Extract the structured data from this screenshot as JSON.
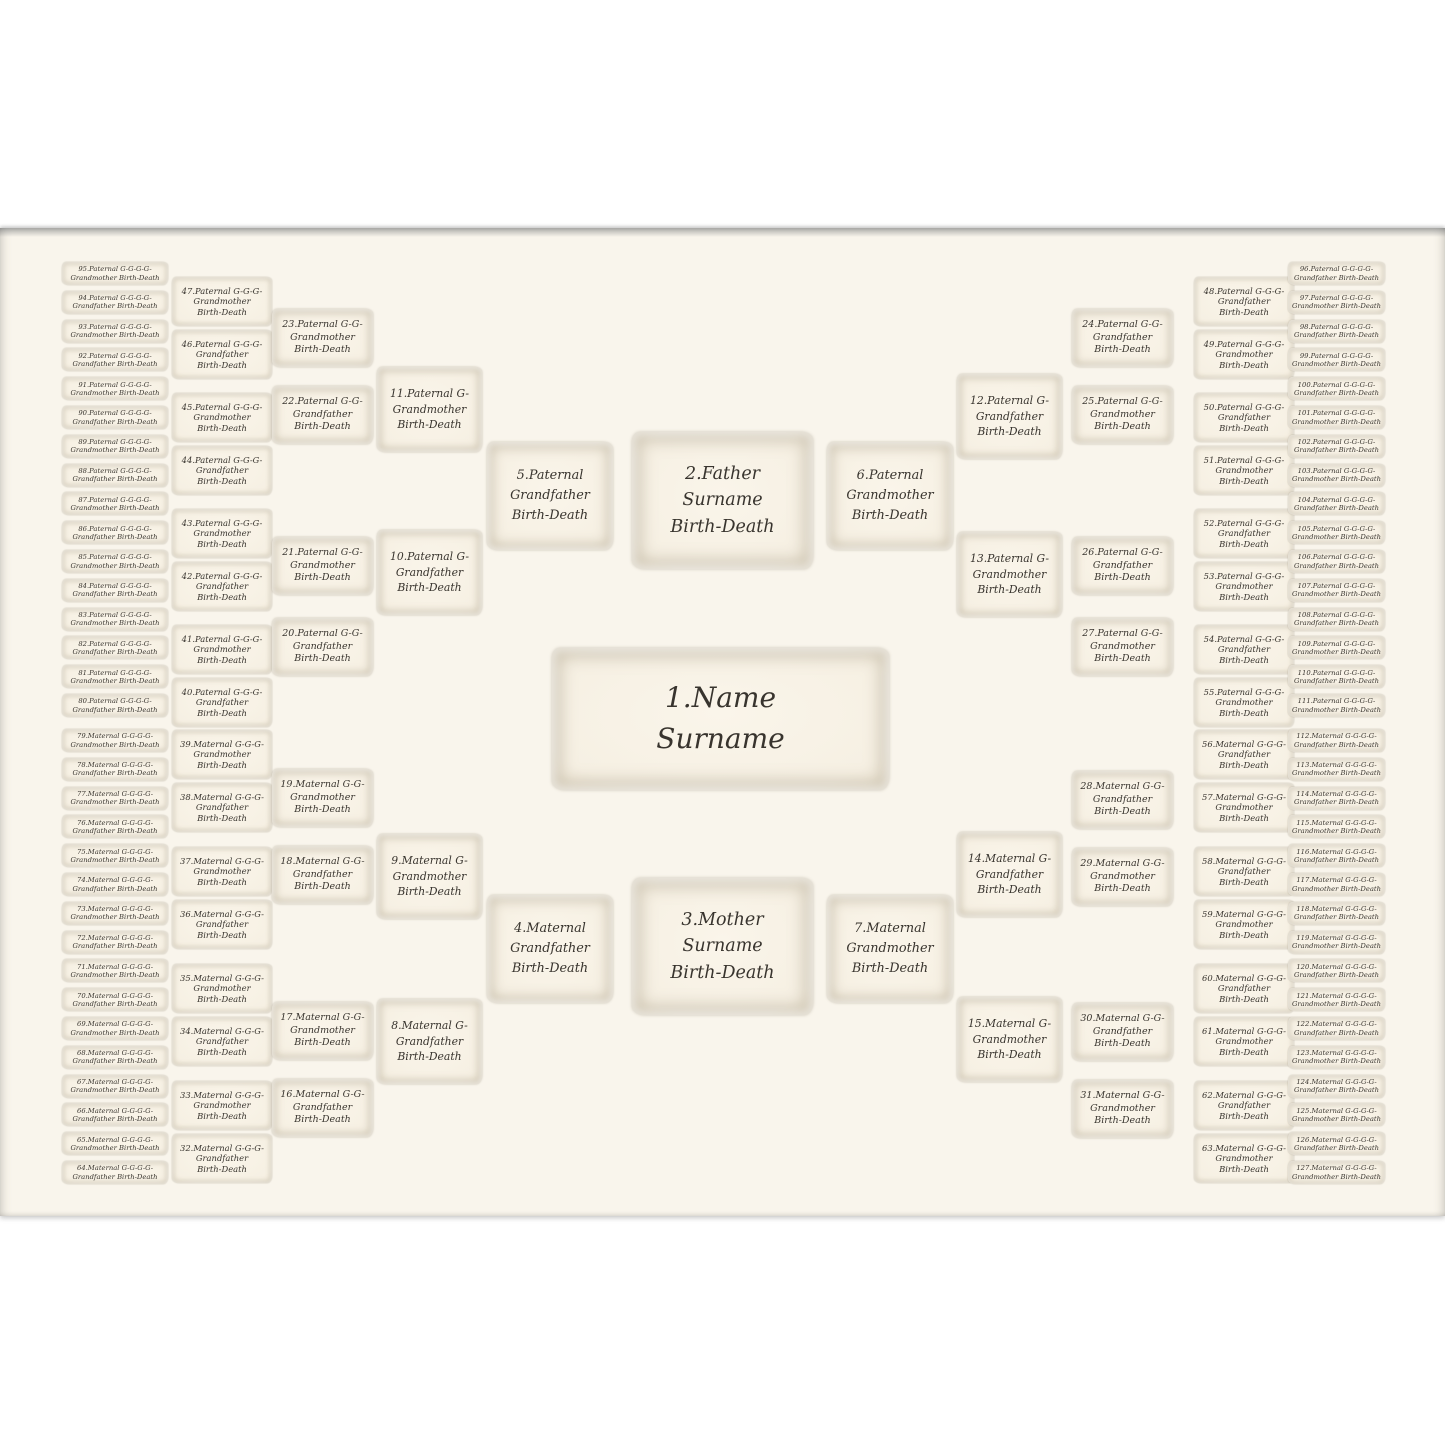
{
  "poster": {
    "background": "#f9f5ec",
    "text_color": "#38342e",
    "box_fill": "#f6f0e3",
    "box_edge": "#c7bba2"
  },
  "center": {
    "line1": "1.Name",
    "line2": "Surname"
  },
  "father": {
    "line1": "2.Father",
    "line2": "Surname",
    "line3": "Birth-Death"
  },
  "mother": {
    "line1": "3.Mother",
    "line2": "Surname",
    "line3": "Birth-Death"
  },
  "columns": {
    "gen3_left": [
      {
        "label": "5.Paternal Grandfather",
        "dates": "Birth-Death"
      },
      {
        "label": "4.Maternal Grandfather",
        "dates": "Birth-Death"
      }
    ],
    "gen3_right": [
      {
        "label": "6.Paternal Grandmother",
        "dates": "Birth-Death"
      },
      {
        "label": "7.Maternal Grandmother",
        "dates": "Birth-Death"
      }
    ],
    "gen4_left": [
      {
        "label": "11.Paternal G-Grandmother",
        "dates": "Birth-Death"
      },
      {
        "label": "10.Paternal G-Grandfather",
        "dates": "Birth-Death"
      },
      {
        "label": "9.Maternal G-Grandmother",
        "dates": "Birth-Death"
      },
      {
        "label": "8.Maternal G-Grandfather",
        "dates": "Birth-Death"
      }
    ],
    "gen4_right": [
      {
        "label": "12.Paternal G-Grandfather",
        "dates": "Birth-Death"
      },
      {
        "label": "13.Paternal G-Grandmother",
        "dates": "Birth-Death"
      },
      {
        "label": "14.Maternal G-Grandfather",
        "dates": "Birth-Death"
      },
      {
        "label": "15.Maternal G-Grandmother",
        "dates": "Birth-Death"
      }
    ],
    "gen5_left": [
      {
        "label": "23.Paternal G-G-Grandmother",
        "dates": "Birth-Death"
      },
      {
        "label": "22.Paternal G-G-Grandfather",
        "dates": "Birth-Death"
      },
      {
        "label": "21.Paternal G-G-Grandmother",
        "dates": "Birth-Death"
      },
      {
        "label": "20.Paternal G-G-Grandfather",
        "dates": "Birth-Death"
      },
      {
        "label": "19.Maternal G-G-Grandmother",
        "dates": "Birth-Death"
      },
      {
        "label": "18.Maternal G-G-Grandfather",
        "dates": "Birth-Death"
      },
      {
        "label": "17.Maternal G-G-Grandmother",
        "dates": "Birth-Death"
      },
      {
        "label": "16.Maternal G-G-Grandfather",
        "dates": "Birth-Death"
      }
    ],
    "gen5_right": [
      {
        "label": "24.Paternal G-G-Grandfather",
        "dates": "Birth-Death"
      },
      {
        "label": "25.Paternal G-G-Grandmother",
        "dates": "Birth-Death"
      },
      {
        "label": "26.Paternal G-G-Grandfather",
        "dates": "Birth-Death"
      },
      {
        "label": "27.Paternal G-G-Grandmother",
        "dates": "Birth-Death"
      },
      {
        "label": "28.Maternal G-G-Grandfather",
        "dates": "Birth-Death"
      },
      {
        "label": "29.Maternal G-G-Grandmother",
        "dates": "Birth-Death"
      },
      {
        "label": "30.Maternal G-G-Grandfather",
        "dates": "Birth-Death"
      },
      {
        "label": "31.Maternal G-G-Grandmother",
        "dates": "Birth-Death"
      }
    ],
    "gen6_left": [
      {
        "label": "47.Paternal G-G-G-Grandmother",
        "dates": "Birth-Death"
      },
      {
        "label": "46.Paternal G-G-G-Grandfather",
        "dates": "Birth-Death"
      },
      {
        "label": "45.Paternal G-G-G-Grandmother",
        "dates": "Birth-Death"
      },
      {
        "label": "44.Paternal G-G-G-Grandfather",
        "dates": "Birth-Death"
      },
      {
        "label": "43.Paternal G-G-G-Grandmother",
        "dates": "Birth-Death"
      },
      {
        "label": "42.Paternal G-G-G-Grandfather",
        "dates": "Birth-Death"
      },
      {
        "label": "41.Paternal G-G-G-Grandmother",
        "dates": "Birth-Death"
      },
      {
        "label": "40.Paternal G-G-G-Grandfather",
        "dates": "Birth-Death"
      },
      {
        "label": "39.Maternal G-G-G-Grandmother",
        "dates": "Birth-Death"
      },
      {
        "label": "38.Maternal G-G-G-Grandfather",
        "dates": "Birth-Death"
      },
      {
        "label": "37.Maternal G-G-G-Grandmother",
        "dates": "Birth-Death"
      },
      {
        "label": "36.Maternal G-G-G-Grandfather",
        "dates": "Birth-Death"
      },
      {
        "label": "35.Maternal G-G-G-Grandmother",
        "dates": "Birth-Death"
      },
      {
        "label": "34.Maternal G-G-G-Grandfather",
        "dates": "Birth-Death"
      },
      {
        "label": "33.Maternal G-G-G-Grandmother",
        "dates": "Birth-Death"
      },
      {
        "label": "32.Maternal G-G-G-Grandfather",
        "dates": "Birth-Death"
      }
    ],
    "gen6_right": [
      {
        "label": "48.Paternal G-G-G-Grandfather",
        "dates": "Birth-Death"
      },
      {
        "label": "49.Paternal G-G-G-Grandmother",
        "dates": "Birth-Death"
      },
      {
        "label": "50.Paternal G-G-G-Grandfather",
        "dates": "Birth-Death"
      },
      {
        "label": "51.Paternal G-G-G-Grandmother",
        "dates": "Birth-Death"
      },
      {
        "label": "52.Paternal G-G-G-Grandfather",
        "dates": "Birth-Death"
      },
      {
        "label": "53.Paternal G-G-G-Grandmother",
        "dates": "Birth-Death"
      },
      {
        "label": "54.Paternal G-G-G-Grandfather",
        "dates": "Birth-Death"
      },
      {
        "label": "55.Paternal G-G-G-Grandmother",
        "dates": "Birth-Death"
      },
      {
        "label": "56.Maternal G-G-G-Grandfather",
        "dates": "Birth-Death"
      },
      {
        "label": "57.Maternal G-G-G-Grandmother",
        "dates": "Birth-Death"
      },
      {
        "label": "58.Maternal G-G-G-Grandfather",
        "dates": "Birth-Death"
      },
      {
        "label": "59.Maternal G-G-G-Grandmother",
        "dates": "Birth-Death"
      },
      {
        "label": "60.Maternal G-G-G-Grandfather",
        "dates": "Birth-Death"
      },
      {
        "label": "61.Maternal G-G-G-Grandmother",
        "dates": "Birth-Death"
      },
      {
        "label": "62.Maternal G-G-G-Grandfather",
        "dates": "Birth-Death"
      },
      {
        "label": "63.Maternal G-G-G-Grandmother",
        "dates": "Birth-Death"
      }
    ],
    "gen7_left": [
      {
        "label": "95.Paternal G-G-G-G-Grandmother",
        "dates": "Birth-Death"
      },
      {
        "label": "94.Paternal G-G-G-G-Grandfather",
        "dates": "Birth-Death"
      },
      {
        "label": "93.Paternal G-G-G-G-Grandmother",
        "dates": "Birth-Death"
      },
      {
        "label": "92.Paternal G-G-G-G-Grandfather",
        "dates": "Birth-Death"
      },
      {
        "label": "91.Paternal G-G-G-G-Grandmother",
        "dates": "Birth-Death"
      },
      {
        "label": "90.Paternal G-G-G-G-Grandfather",
        "dates": "Birth-Death"
      },
      {
        "label": "89.Paternal G-G-G-G-Grandmother",
        "dates": "Birth-Death"
      },
      {
        "label": "88.Paternal G-G-G-G-Grandfather",
        "dates": "Birth-Death"
      },
      {
        "label": "87.Paternal G-G-G-G-Grandmother",
        "dates": "Birth-Death"
      },
      {
        "label": "86.Paternal G-G-G-G-Grandfather",
        "dates": "Birth-Death"
      },
      {
        "label": "85.Paternal G-G-G-G-Grandmother",
        "dates": "Birth-Death"
      },
      {
        "label": "84.Paternal G-G-G-G-Grandfather",
        "dates": "Birth-Death"
      },
      {
        "label": "83.Paternal G-G-G-G-Grandmother",
        "dates": "Birth-Death"
      },
      {
        "label": "82.Paternal G-G-G-G-Grandfather",
        "dates": "Birth-Death"
      },
      {
        "label": "81.Paternal G-G-G-G-Grandmother",
        "dates": "Birth-Death"
      },
      {
        "label": "80.Paternal G-G-G-G-Grandfather",
        "dates": "Birth-Death"
      },
      {
        "label": "79.Maternal G-G-G-G-Grandmother",
        "dates": "Birth-Death"
      },
      {
        "label": "78.Maternal G-G-G-G-Grandfather",
        "dates": "Birth-Death"
      },
      {
        "label": "77.Maternal G-G-G-G-Grandmother",
        "dates": "Birth-Death"
      },
      {
        "label": "76.Maternal G-G-G-G-Grandfather",
        "dates": "Birth-Death"
      },
      {
        "label": "75.Maternal G-G-G-G-Grandmother",
        "dates": "Birth-Death"
      },
      {
        "label": "74.Maternal G-G-G-G-Grandfather",
        "dates": "Birth-Death"
      },
      {
        "label": "73.Maternal G-G-G-G-Grandmother",
        "dates": "Birth-Death"
      },
      {
        "label": "72.Maternal G-G-G-G-Grandfather",
        "dates": "Birth-Death"
      },
      {
        "label": "71.Maternal G-G-G-G-Grandmother",
        "dates": "Birth-Death"
      },
      {
        "label": "70.Maternal G-G-G-G-Grandfather",
        "dates": "Birth-Death"
      },
      {
        "label": "69.Maternal G-G-G-G-Grandmother",
        "dates": "Birth-Death"
      },
      {
        "label": "68.Maternal G-G-G-G-Grandfather",
        "dates": "Birth-Death"
      },
      {
        "label": "67.Maternal G-G-G-G-Grandmother",
        "dates": "Birth-Death"
      },
      {
        "label": "66.Maternal G-G-G-G-Grandfather",
        "dates": "Birth-Death"
      },
      {
        "label": "65.Maternal G-G-G-G-Grandmother",
        "dates": "Birth-Death"
      },
      {
        "label": "64.Maternal G-G-G-G-Grandfather",
        "dates": "Birth-Death"
      }
    ],
    "gen7_right": [
      {
        "label": "96.Paternal G-G-G-G-Grandfather",
        "dates": "Birth-Death"
      },
      {
        "label": "97.Paternal G-G-G-G-Grandmother",
        "dates": "Birth-Death"
      },
      {
        "label": "98.Paternal G-G-G-G-Grandfather",
        "dates": "Birth-Death"
      },
      {
        "label": "99.Paternal G-G-G-G-Grandmother",
        "dates": "Birth-Death"
      },
      {
        "label": "100.Paternal G-G-G-G-Grandfather",
        "dates": "Birth-Death"
      },
      {
        "label": "101.Paternal G-G-G-G-Grandmother",
        "dates": "Birth-Death"
      },
      {
        "label": "102.Paternal G-G-G-G-Grandfather",
        "dates": "Birth-Death"
      },
      {
        "label": "103.Paternal G-G-G-G-Grandmother",
        "dates": "Birth-Death"
      },
      {
        "label": "104.Paternal G-G-G-G-Grandfather",
        "dates": "Birth-Death"
      },
      {
        "label": "105.Paternal G-G-G-G-Grandmother",
        "dates": "Birth-Death"
      },
      {
        "label": "106.Paternal G-G-G-G-Grandfather",
        "dates": "Birth-Death"
      },
      {
        "label": "107.Paternal G-G-G-G-Grandmother",
        "dates": "Birth-Death"
      },
      {
        "label": "108.Paternal G-G-G-G-Grandfather",
        "dates": "Birth-Death"
      },
      {
        "label": "109.Paternal G-G-G-G-Grandmother",
        "dates": "Birth-Death"
      },
      {
        "label": "110.Paternal G-G-G-G-Grandfather",
        "dates": "Birth-Death"
      },
      {
        "label": "111.Paternal G-G-G-G-Grandmother",
        "dates": "Birth-Death"
      },
      {
        "label": "112.Maternal G-G-G-G-Grandfather",
        "dates": "Birth-Death"
      },
      {
        "label": "113.Maternal G-G-G-G-Grandmother",
        "dates": "Birth-Death"
      },
      {
        "label": "114.Maternal G-G-G-G-Grandfather",
        "dates": "Birth-Death"
      },
      {
        "label": "115.Maternal G-G-G-G-Grandmother",
        "dates": "Birth-Death"
      },
      {
        "label": "116.Maternal G-G-G-G-Grandfather",
        "dates": "Birth-Death"
      },
      {
        "label": "117.Maternal G-G-G-G-Grandmother",
        "dates": "Birth-Death"
      },
      {
        "label": "118.Maternal G-G-G-G-Grandfather",
        "dates": "Birth-Death"
      },
      {
        "label": "119.Maternal G-G-G-G-Grandmother",
        "dates": "Birth-Death"
      },
      {
        "label": "120.Maternal G-G-G-G-Grandfather",
        "dates": "Birth-Death"
      },
      {
        "label": "121.Maternal G-G-G-G-Grandmother",
        "dates": "Birth-Death"
      },
      {
        "label": "122.Maternal G-G-G-G-Grandfather",
        "dates": "Birth-Death"
      },
      {
        "label": "123.Maternal G-G-G-G-Grandmother",
        "dates": "Birth-Death"
      },
      {
        "label": "124.Maternal G-G-G-G-Grandfather",
        "dates": "Birth-Death"
      },
      {
        "label": "125.Maternal G-G-G-G-Grandmother",
        "dates": "Birth-Death"
      },
      {
        "label": "126.Maternal G-G-G-G-Grandfather",
        "dates": "Birth-Death"
      },
      {
        "label": "127.Maternal G-G-G-G-Grandmother",
        "dates": "Birth-Death"
      }
    ]
  }
}
